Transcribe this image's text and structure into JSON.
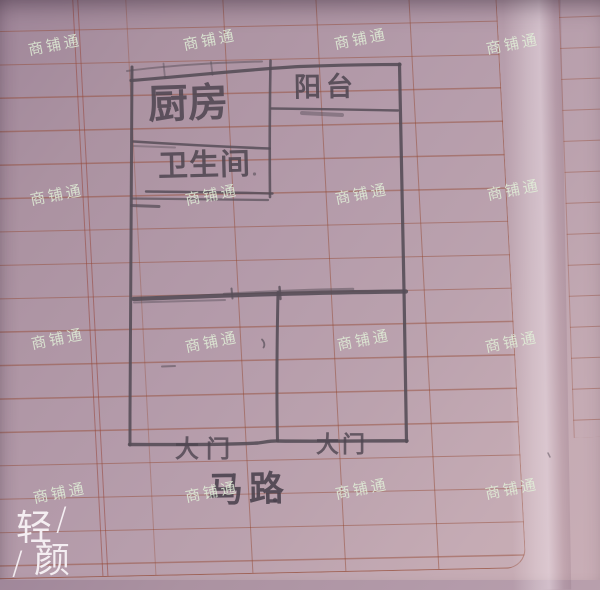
{
  "floor_plan": {
    "rooms": [
      {
        "id": "kitchen",
        "label": "厨房"
      },
      {
        "id": "balcony",
        "label": "阳台"
      },
      {
        "id": "bathroom",
        "label": "卫生间"
      }
    ],
    "doors": [
      {
        "label": "大门"
      },
      {
        "label": "大门"
      }
    ],
    "road_label": "马路"
  },
  "watermark": {
    "text": "商铺通",
    "positions": [
      {
        "x": 28,
        "y": 38
      },
      {
        "x": 183,
        "y": 33
      },
      {
        "x": 334,
        "y": 32
      },
      {
        "x": 486,
        "y": 37
      },
      {
        "x": 30,
        "y": 188
      },
      {
        "x": 185,
        "y": 188
      },
      {
        "x": 335,
        "y": 187
      },
      {
        "x": 487,
        "y": 183
      },
      {
        "x": 31,
        "y": 332
      },
      {
        "x": 185,
        "y": 335
      },
      {
        "x": 337,
        "y": 333
      },
      {
        "x": 485,
        "y": 335
      },
      {
        "x": 33,
        "y": 486
      },
      {
        "x": 185,
        "y": 485
      },
      {
        "x": 335,
        "y": 482
      },
      {
        "x": 485,
        "y": 482
      }
    ]
  },
  "camera_logo": {
    "char_top": "轻",
    "char_bottom": "颜",
    "slash": "/"
  },
  "colors": {
    "paper": "#b59caa",
    "grid_line": "#94492f",
    "pencil": "#574e58",
    "watermark_text": "#e2f1d9",
    "logo_text": "#f4eef2"
  }
}
